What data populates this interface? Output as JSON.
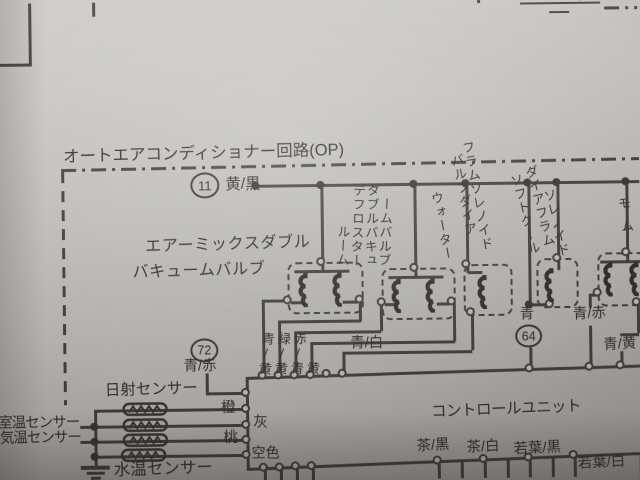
{
  "photo_page": {
    "top_right_cutoff_text": "(55W×"
  },
  "title": "オートエアコンディショナー回路(OP)",
  "connectors": {
    "c11": {
      "num": "11",
      "wire": "黄/黒"
    },
    "c72": {
      "num": "72",
      "wire": "青/赤"
    },
    "c64": {
      "num": "64",
      "wire": "青"
    }
  },
  "valves": {
    "air_mix": {
      "line1": "エアーミックスダブル",
      "line2": "バキュームバルブ"
    },
    "room_defroster": {
      "cols": [
        "ルーム",
        "デフロスター",
        "ダブルバキュ",
        "ームバルブ"
      ]
    },
    "water_valve": {
      "cols": [
        "ウォーター",
        "バルブダイア",
        "フラムソレノイド"
      ]
    },
    "soft_cool": {
      "cols": [
        "ソフトクール",
        "ダイアフラム",
        "ソレノイド"
      ]
    },
    "right_edge_partial": {
      "cols": [
        "モム"
      ]
    }
  },
  "wire_labels": {
    "to_unit_left": [
      "青/黄",
      "緑/黄",
      "赤/青",
      "黄"
    ],
    "ao_shiro": "青/白",
    "ao_aka": "青/赤",
    "ao_ki": "青/黄"
  },
  "sensors": {
    "solar": "日射センサー",
    "room": "室温センサー",
    "outside": "外気温センサー",
    "water": "水温センサー",
    "wires": {
      "orange": "橙",
      "gray": "灰",
      "pink": "桃",
      "sky": "空色"
    }
  },
  "control_unit": {
    "label": "コントロールユニット",
    "bottom_wires": [
      "茶/黒",
      "茶/白",
      "若葉/黒",
      "若葉/白"
    ]
  }
}
